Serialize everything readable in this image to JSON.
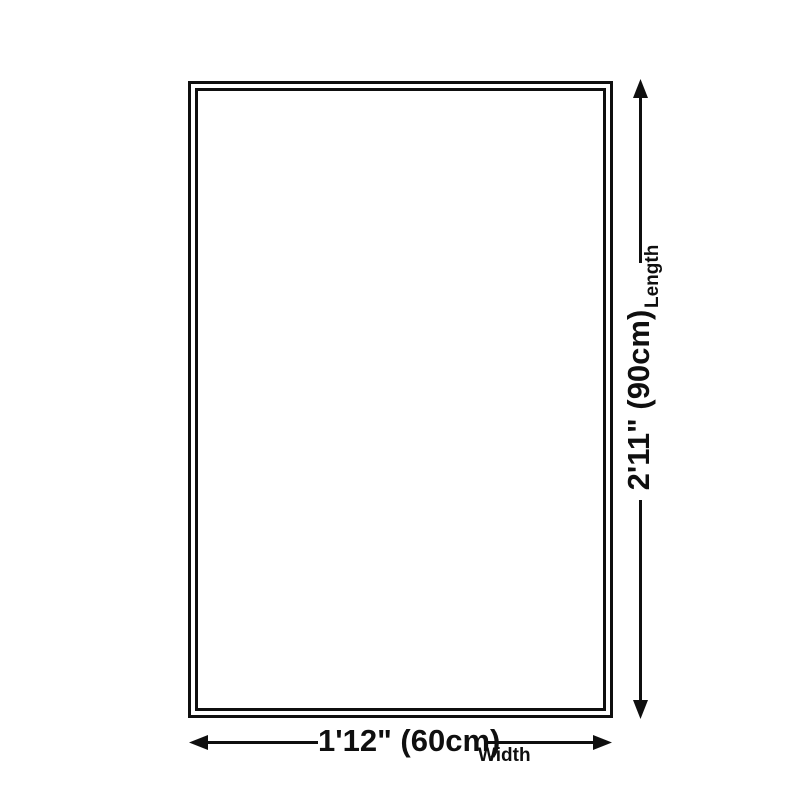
{
  "diagram": {
    "type": "product-dimension-diagram",
    "dimensions": {
      "width": {
        "value": "1'12\" (60cm)",
        "label": "Width"
      },
      "length": {
        "value": "2'11\" (90cm)",
        "label": "Length"
      }
    },
    "colors": {
      "line": "#0f0f0f",
      "background": "#ffffff"
    }
  }
}
